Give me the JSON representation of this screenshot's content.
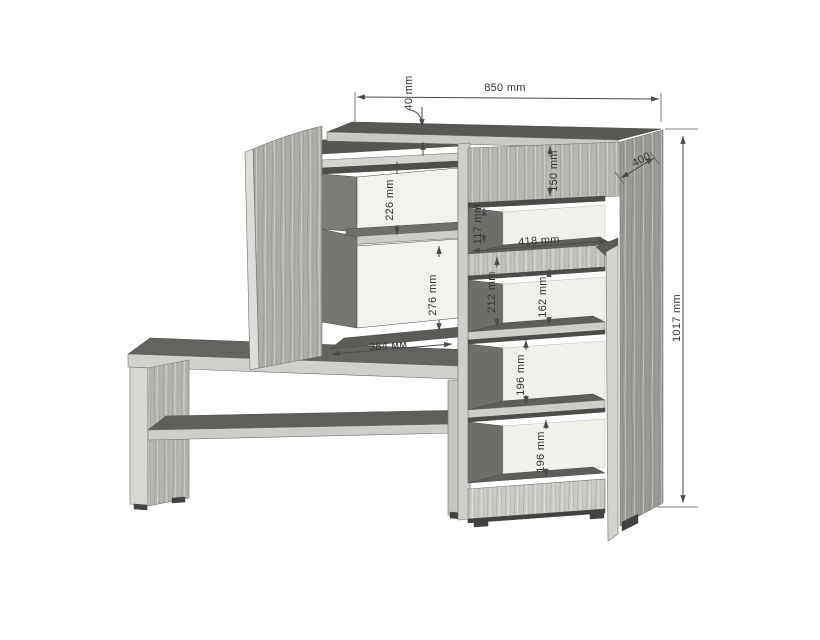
{
  "drawing": {
    "kind": "furniture-dimension-drawing",
    "dims": {
      "overall_width": "850 mm",
      "top_thickness": "40 mm",
      "depth": "400",
      "overall_height": "1017 mm",
      "top_niche_height": "150 mm",
      "left_upper_niche": "226 mm",
      "left_lower_niche": "276 mm",
      "right_upper_niche": "117 mm",
      "shelf_width": "418 mm",
      "flap_niche_total": "212 mm",
      "flap_niche_open": "162 mm",
      "lower_niche_1": "196 mm",
      "lower_niche_2": "196 mm",
      "base_width": "384 мм"
    },
    "colors": {
      "background": "#ffffff",
      "dimension_lines": "#4a4a4a",
      "wood_light_edge": "#d3d5d0",
      "wood_front": "#b6b9b3",
      "wood_side": "#9a9d97",
      "surface_dark_top": "#5d605a",
      "back_panel": "#f2f1eb",
      "feet": "#3f423e"
    }
  }
}
